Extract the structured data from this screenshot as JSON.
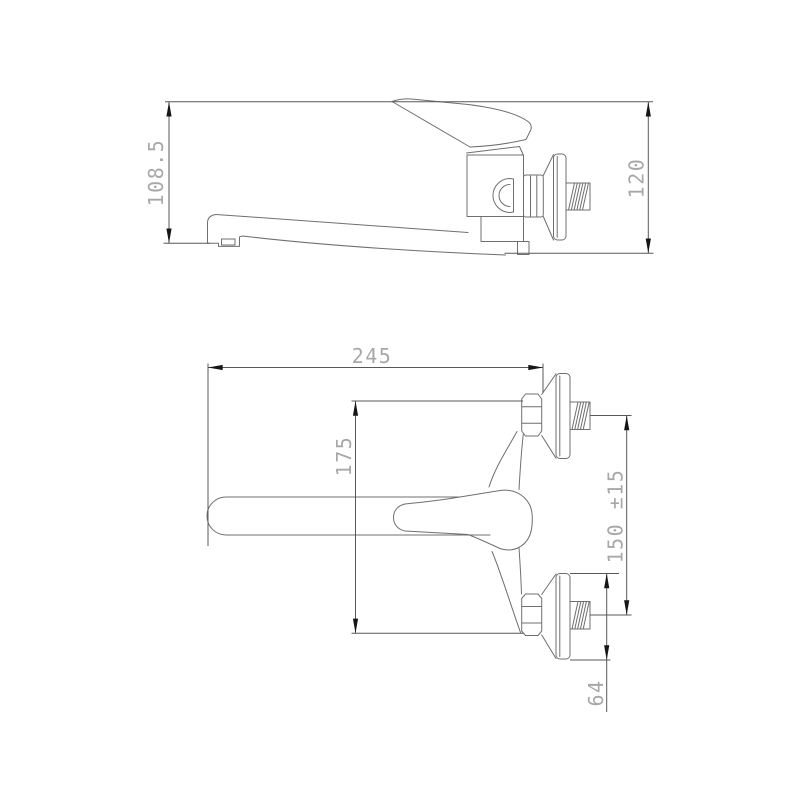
{
  "drawing": {
    "kind": "technical-drawing",
    "colors": {
      "background": "#ffffff",
      "outline": "#6f6f6f",
      "dimension_line": "#585858",
      "dimension_text": "#a8a8a8",
      "arrowhead": "#161616"
    },
    "side_view": {
      "dim_spout_height": "108.5",
      "dim_overall_height": "120"
    },
    "plan_view": {
      "dim_overall_length": "245",
      "dim_body_depth": "175",
      "dim_inlet_centers": "150 ±15",
      "dim_flange_diameter": "64"
    }
  }
}
